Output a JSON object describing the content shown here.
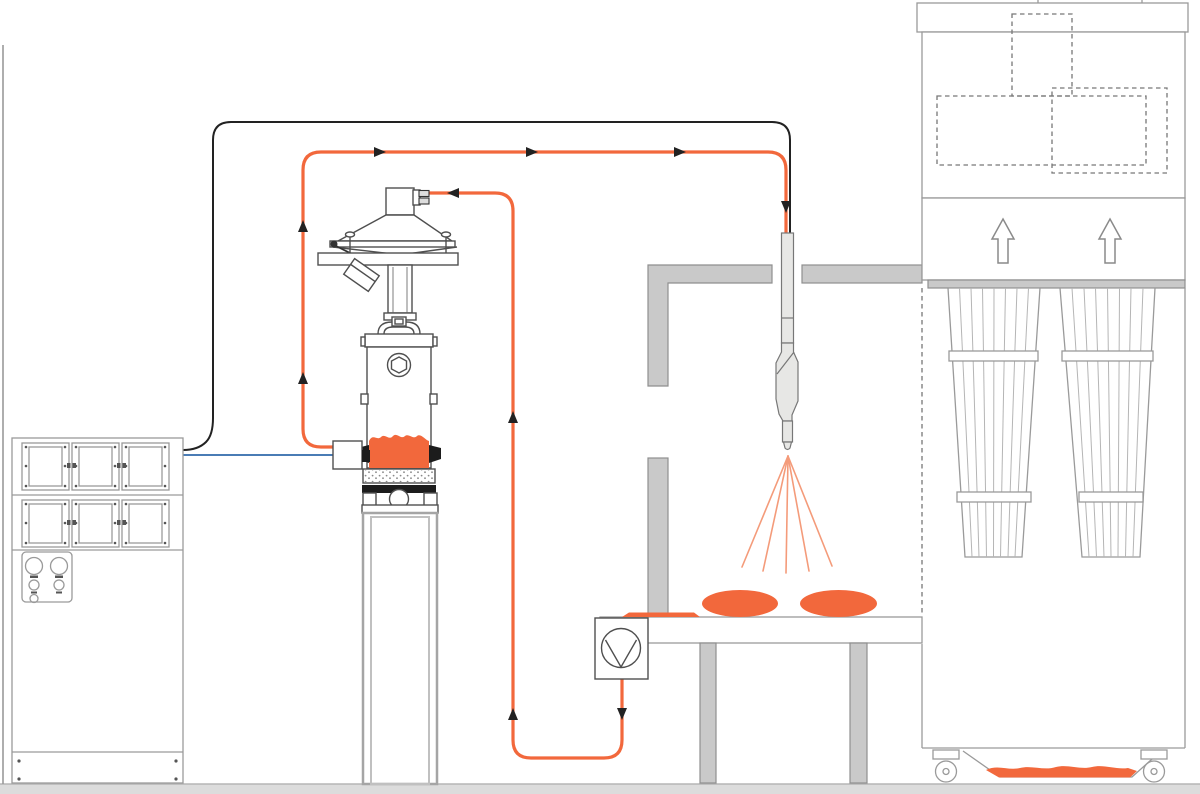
{
  "meta": {
    "title": "Powder coating system schematic",
    "canvas": {
      "width": 1200,
      "height": 794
    },
    "visible_text": []
  },
  "colors": {
    "powder_orange": "#F2683C",
    "spray_orange": "#F49B7A",
    "cable_black": "#222222",
    "signal_blue": "#4A7CB5",
    "machine_outline": "#4f4f4f",
    "light_outline": "#9A9A9A",
    "wall_fill": "#C9C9C9",
    "wall_stroke": "#8F8F8F",
    "floor_fill": "#DCDCDC",
    "dashed_line": "#777777",
    "background": "#FFFFFF"
  },
  "components": {
    "control_cabinet": {
      "name": "Control cabinet",
      "module_rows": 2,
      "modules_per_row": 3,
      "knobs_large": 2,
      "knobs_small": 3
    },
    "vibrating_sieve": {
      "name": "Vibrating sieve with feed inlet and drive motor"
    },
    "powder_hopper": {
      "name": "Fluidized powder hopper with sight glass",
      "powder_level": "filled"
    },
    "injector": {
      "name": "Powder injector on hopper"
    },
    "hopper_stand": {
      "name": "Hopper stand column"
    },
    "spray_gun": {
      "name": "Automatic powder spray gun through booth ceiling slot"
    },
    "booth": {
      "name": "Spray booth walls (cross-section)"
    },
    "workpieces": {
      "name": "Coated workpiece discs",
      "count": 2
    },
    "conveyor_table": {
      "name": "Work table with legs",
      "legs": 2
    },
    "recovery_pump": {
      "name": "Powder recovery pump"
    },
    "after_filter": {
      "name": "After-filter recovery unit",
      "filter_cartridges": 2,
      "exhaust_arrows": 2,
      "casters": 2,
      "powder_tray": "filled"
    },
    "floor": {
      "name": "Floor"
    },
    "wall": {
      "name": "Left wall line"
    }
  },
  "flows": {
    "supply_hose": {
      "color_key": "powder_orange",
      "from": "injector",
      "to": "spray_gun",
      "arrows": 6
    },
    "recovery_hose": {
      "color_key": "powder_orange",
      "from": "recovery_pump",
      "to": "vibrating_sieve",
      "arrows": 4
    },
    "gun_cable": {
      "color_key": "cable_black",
      "from": "control_cabinet",
      "to": "spray_gun",
      "arrows": 0
    },
    "injector_line": {
      "color_key": "signal_blue",
      "from": "control_cabinet",
      "to": "injector",
      "arrows": 0
    }
  }
}
